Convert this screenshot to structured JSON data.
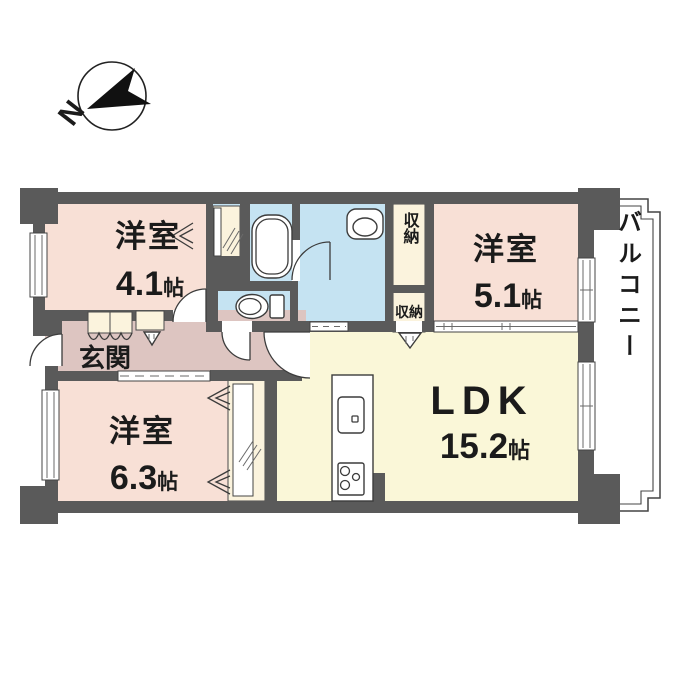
{
  "compass": {
    "north_label": "N"
  },
  "rooms": {
    "western_room_1": {
      "label": "洋室",
      "size_value": "4.1",
      "size_unit": "帖"
    },
    "western_room_2": {
      "label": "洋室",
      "size_value": "5.1",
      "size_unit": "帖"
    },
    "western_room_3": {
      "label": "洋室",
      "size_value": "6.3",
      "size_unit": "帖"
    },
    "ldk": {
      "label": "LDK",
      "size_value": "15.2",
      "size_unit": "帖"
    },
    "entrance": {
      "label": "玄関"
    },
    "storage_upper": {
      "label": "収納"
    },
    "storage_lower": {
      "label": "収納"
    },
    "balcony": {
      "label": "バルコニー"
    }
  },
  "colors": {
    "wall": "#5a5a5a",
    "room_pink": "#f8e0d6",
    "wet_blue": "#c5e3f2",
    "ldk_cream": "#faf7d8",
    "hall_mauve": "#ddc5c1",
    "closet_cream": "#fbf3dd",
    "outline": "#3c3c3c",
    "text": "#1b1b1b"
  }
}
